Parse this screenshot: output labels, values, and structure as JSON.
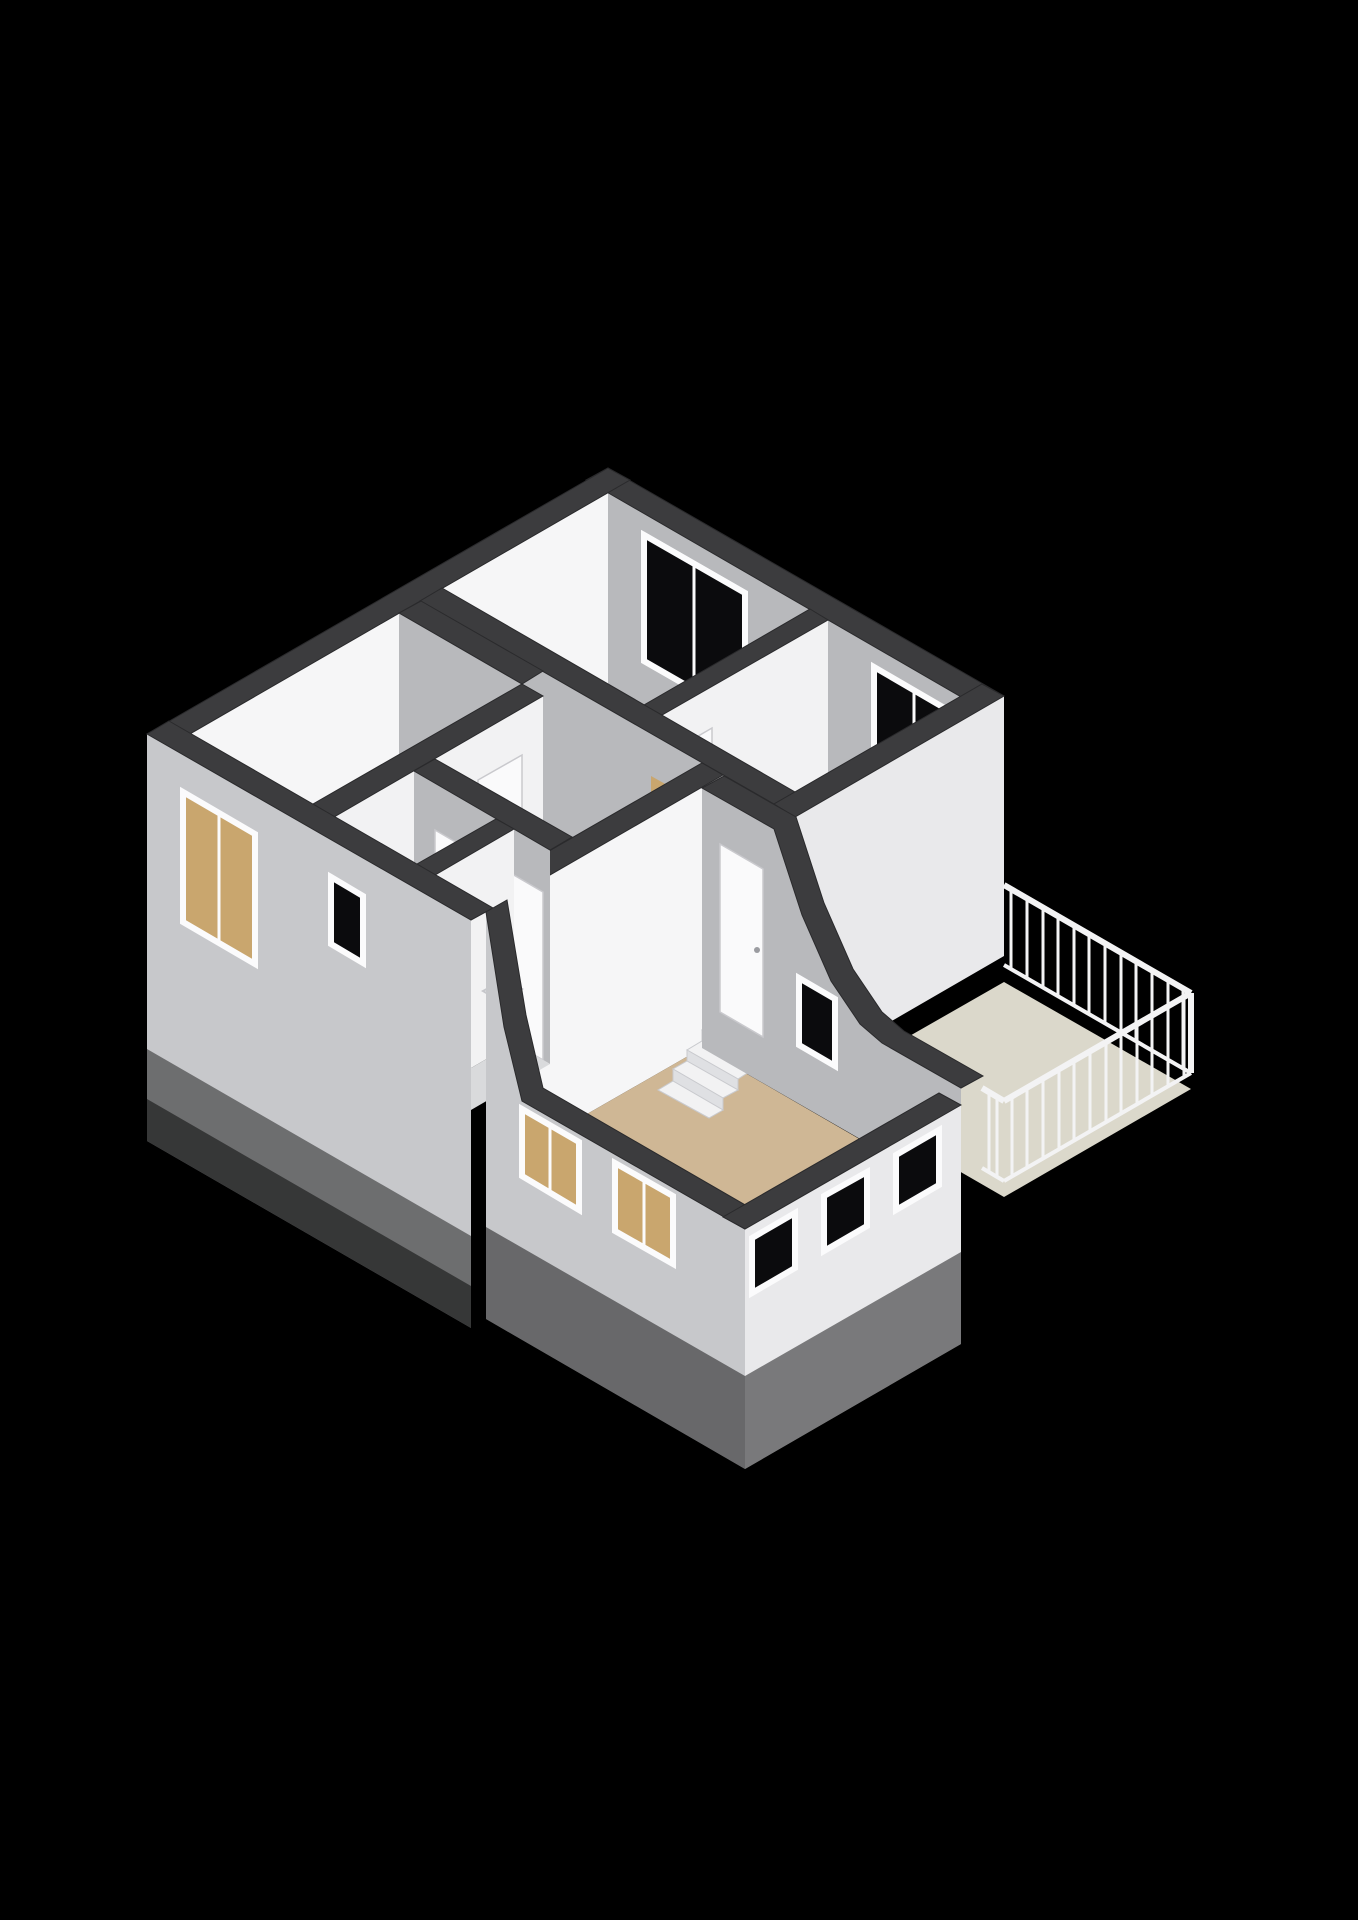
{
  "scene": {
    "kind": "3d-floorplan-isometric-render",
    "background": "#000000",
    "floor_shown": "upper storey with stairwell, bathroom, balcony and lower split-level room"
  },
  "colors": {
    "bg": "#000000",
    "wall_cap": "#3c3c3e",
    "face_bright": "#f2f2f3",
    "face_shade": "#b8b9bc",
    "interior_bright": "#f6f6f7",
    "exterior_sw": "#c7c8cb",
    "exterior_se": "#e9e9eb",
    "floor_tan": "#c7a268",
    "floor_ext": "#cfb795",
    "floor_balcony": "#dbd8cb",
    "floor_bath": "#b9c6d2",
    "floor_wc": "#d9dadc",
    "glass": "#0b0b0d",
    "glass_through": "#c9a66e",
    "frame": "#fbfbfc",
    "door": "#fafafb",
    "stair_light": "#f2f2f3",
    "stair_shade": "#dfe0e3",
    "stair_hole": "#070708",
    "railing": "#f3f3f4",
    "tub": "#f7f7f8",
    "fade": "#000000"
  },
  "inventory": {
    "rooms": [
      "room-top",
      "room-right",
      "room-left",
      "hallway",
      "bathroom",
      "wc",
      "lower-room",
      "balcony"
    ],
    "fixtures": [
      "bathtub",
      "wash-basin",
      "winder-staircase",
      "stairwell-opening",
      "split-level-steps",
      "balcony-railing"
    ],
    "window_count": 9,
    "door_count": 6,
    "step_count": 4
  }
}
